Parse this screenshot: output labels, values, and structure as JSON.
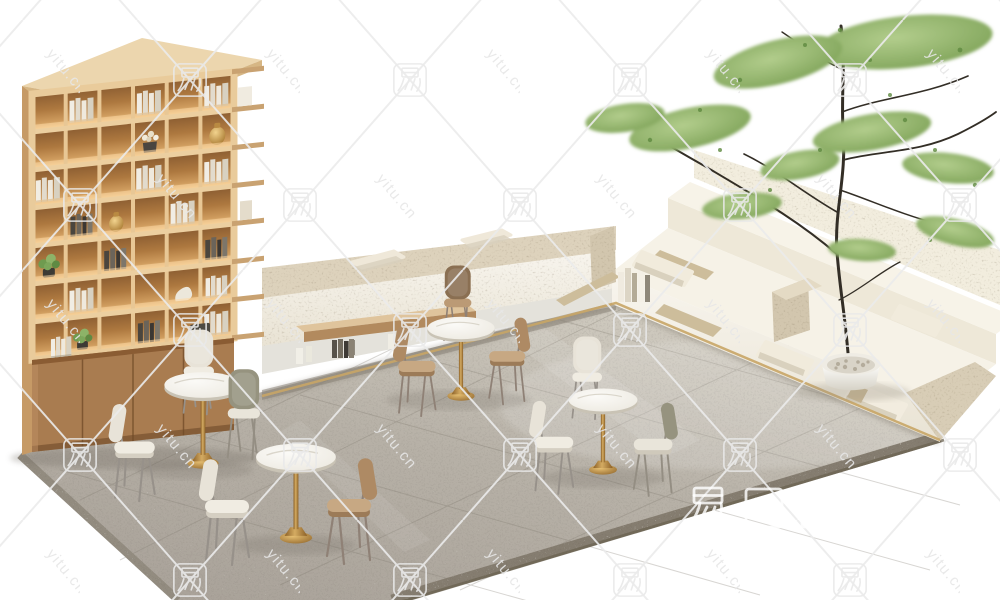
{
  "watermark": {
    "tile_char": "易",
    "site_text": "yitu.cn",
    "brand_text": "易图网"
  },
  "palette": {
    "background": "#ffffff",
    "floor_terrazzo": "#b5afa5",
    "floor_edge": "#8a8377",
    "stone_beige": "#d4c9b3",
    "stone_cream": "#f4f0e6",
    "wood_shelf": "#dcb284",
    "wood_cell_shadow": "#8a5c31",
    "wood_cabinet": "#a97c50",
    "brass": "#b98a42",
    "table_top": "#f3f1ea",
    "cushion_cream": "#efe8d9",
    "leather_tan": "#b6946f",
    "tree_green": "#85a95e",
    "watermark_gray": "#e9e9e9",
    "watermark_white": "#ffffff"
  }
}
